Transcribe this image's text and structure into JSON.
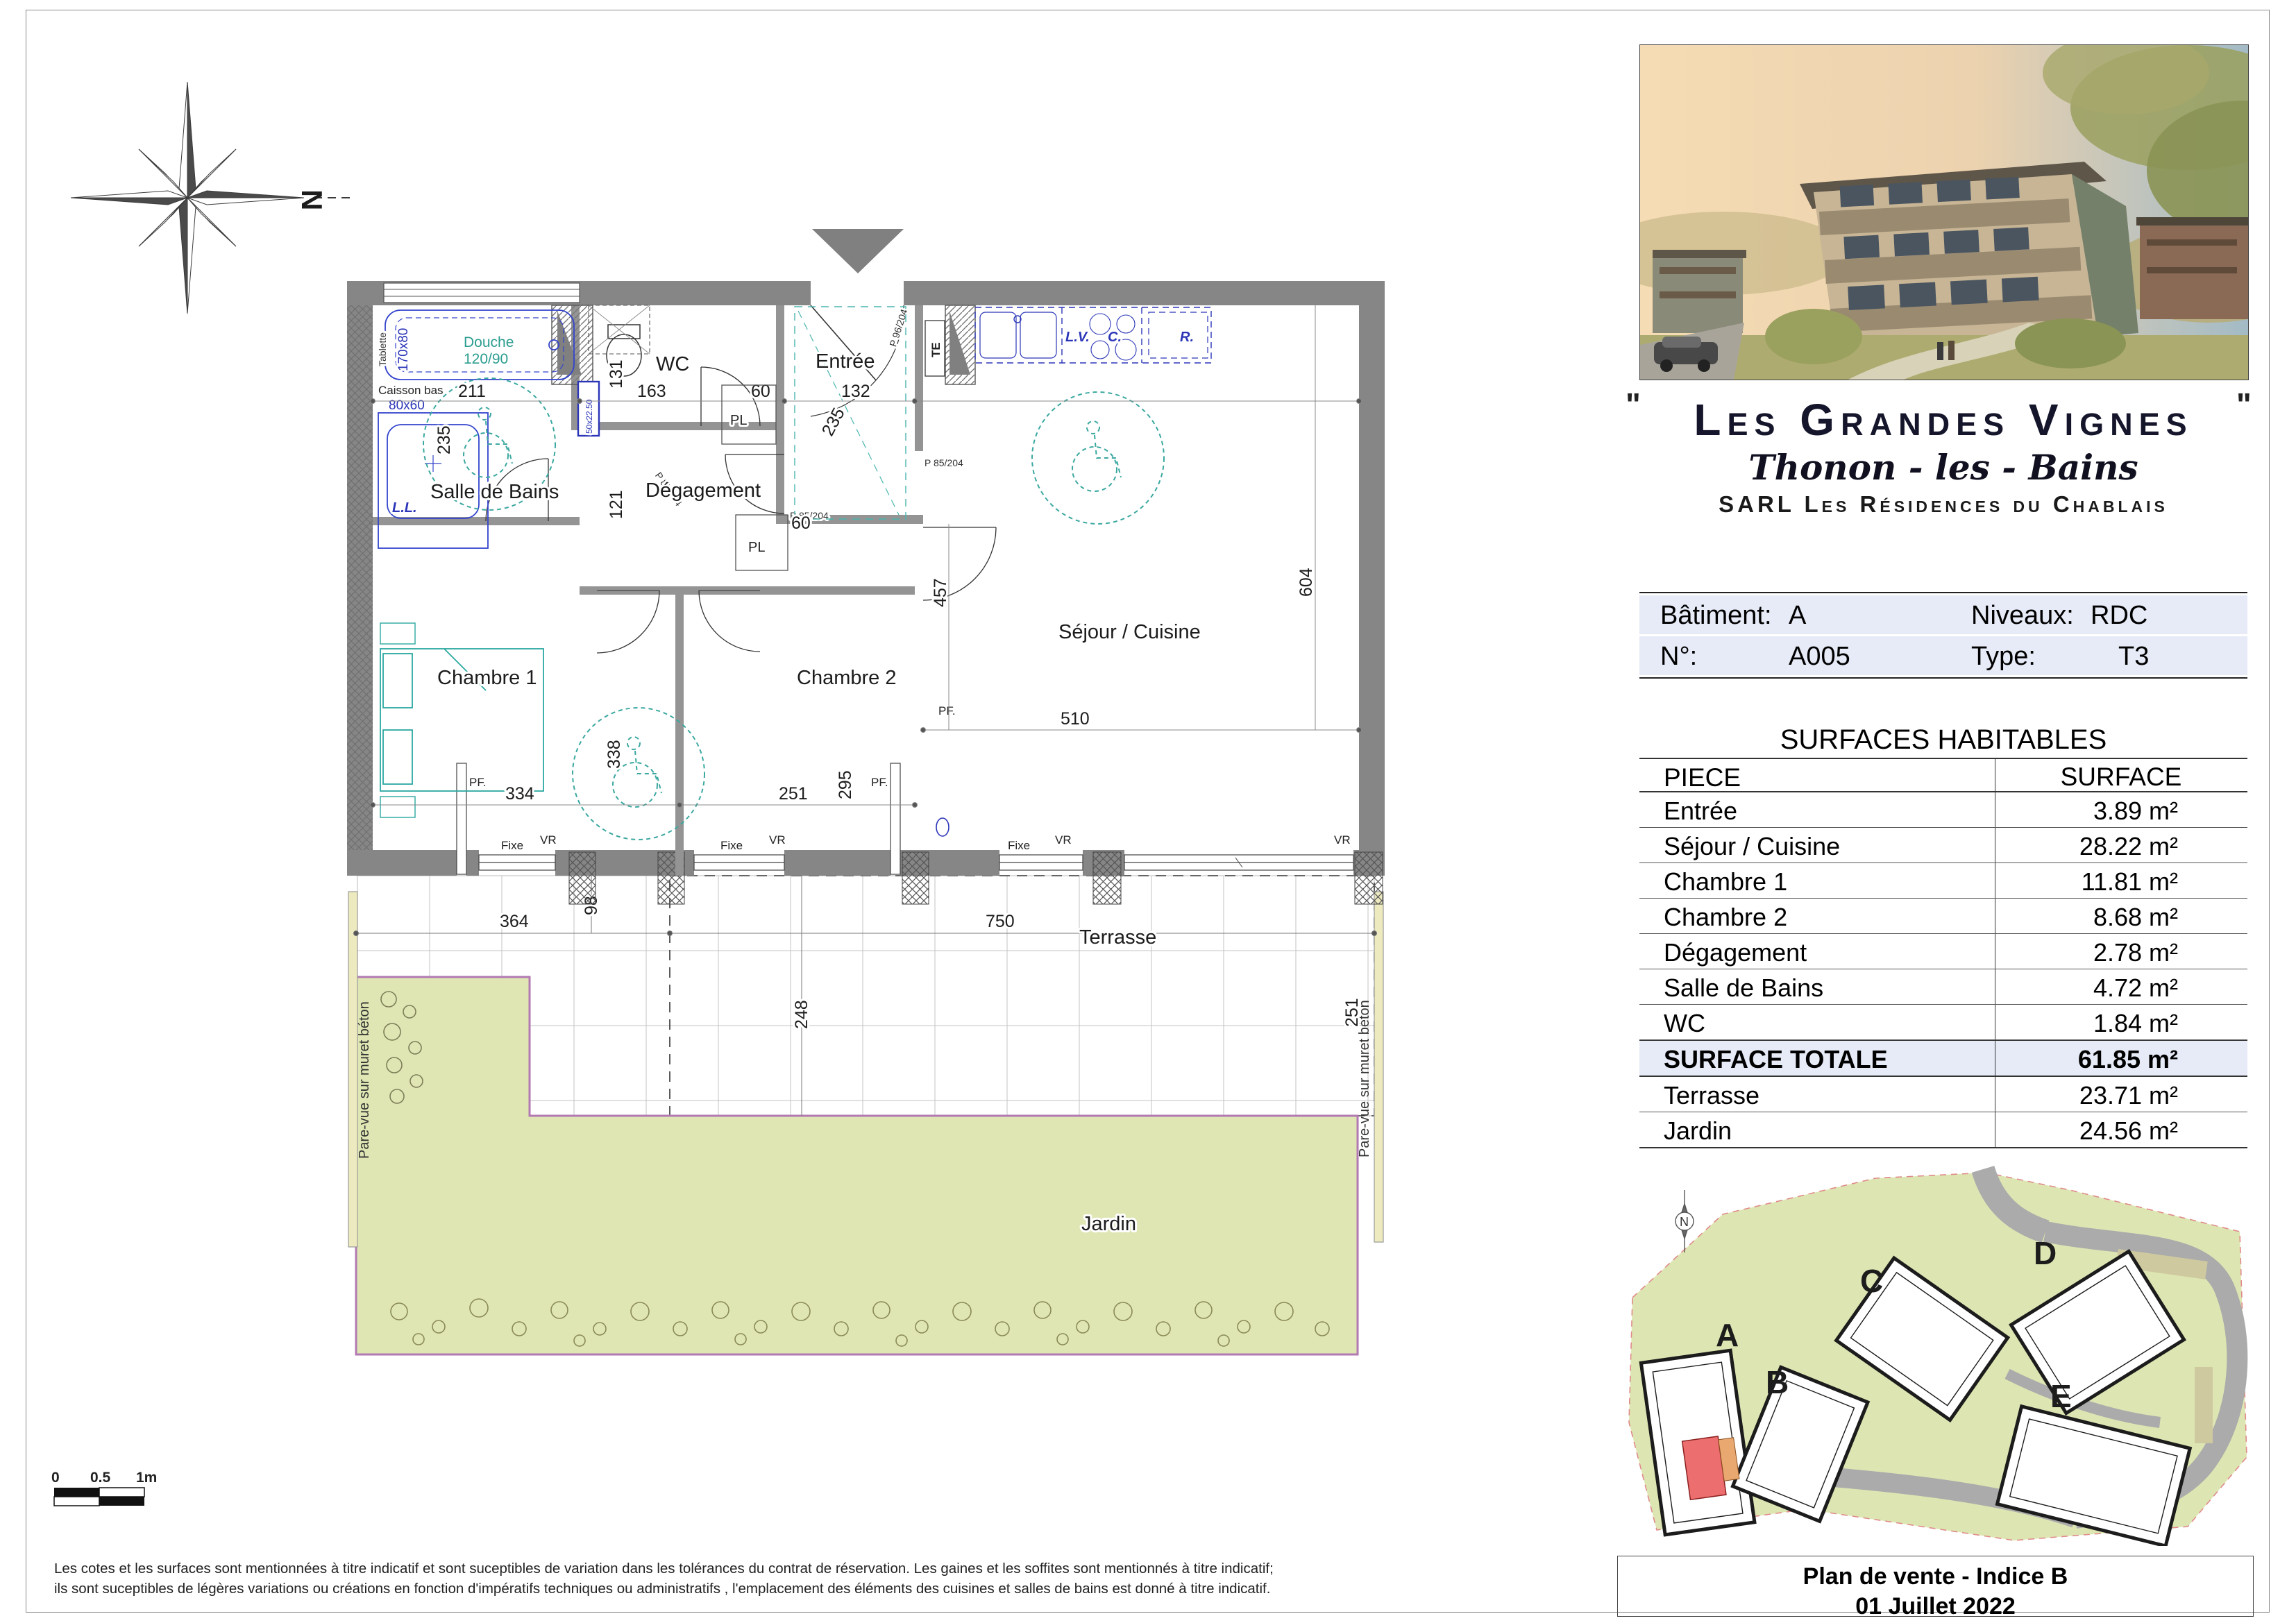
{
  "compass": {
    "north": "N"
  },
  "plan": {
    "rooms": {
      "salle_de_bains": "Salle de Bains",
      "degagement": "Dégagement",
      "wc": "WC",
      "entree": "Entrée",
      "chambre1": "Chambre 1",
      "chambre2": "Chambre 2",
      "sejour": "Séjour / Cuisine",
      "terrasse": "Terrasse",
      "jardin": "Jardin"
    },
    "dims": {
      "d211": "211",
      "d235": "235",
      "d131": "131",
      "d163": "163",
      "d60": "60",
      "d132": "132",
      "d121": "121",
      "d457": "457",
      "d604": "604",
      "d334": "334",
      "d338": "338",
      "d251": "251",
      "d295": "295",
      "d510": "510",
      "d364": "364",
      "d98": "98",
      "d750": "750",
      "d248": "248"
    },
    "fixtures": {
      "douche": "Douche",
      "douche_size": "120/90",
      "bain_size": "170x80",
      "tablette": "Tablette",
      "caisson": "Caisson bas",
      "vasque": "80x60",
      "ll": "L.L.",
      "lavabo": "50x22.50",
      "lv": "L.V.",
      "c": "C.",
      "r": "R.",
      "te": "TE"
    },
    "openings": {
      "pf": "PF.",
      "fixe": "Fixe",
      "vr": "VR",
      "p85": "P 85/204",
      "p96": "P 96/204"
    },
    "pare_vue": "Pare-vue sur muret béton"
  },
  "scale_bar": {
    "t0": "0",
    "t05": "0.5",
    "t1": "1m"
  },
  "disclaimer": {
    "line1": "Les cotes et les surfaces sont mentionnées à titre indicatif et sont suceptibles de variation dans les tolérances du contrat de réservation. Les gaines et les soffites sont mentionnés à titre indicatif;",
    "line2": "ils sont suceptibles de légères variations ou créations en fonction d'impératifs techniques ou administratifs , l'emplacement des éléments des cuisines et salles de bains est donné à titre indicatif."
  },
  "panel": {
    "quote": "\"",
    "title": "Les Grandes Vignes",
    "city": "Thonon - les - Bains",
    "company": "SARL Les Résidences du Chablais",
    "info": {
      "batiment_label": "Bâtiment:",
      "batiment_value": "A",
      "niveaux_label": "Niveaux:",
      "niveaux_value": "RDC",
      "numero_label": "N°:",
      "numero_value": "A005",
      "type_label": "Type:",
      "type_value": "T3"
    },
    "surfaces": {
      "title": "SURFACES HABITABLES",
      "col_piece": "PIECE",
      "col_surface": "SURFACE",
      "rows": [
        {
          "piece": "Entrée",
          "surface": "3.89 m²"
        },
        {
          "piece": "Séjour / Cuisine",
          "surface": "28.22 m²"
        },
        {
          "piece": "Chambre 1",
          "surface": "11.81 m²"
        },
        {
          "piece": "Chambre 2",
          "surface": "8.68 m²"
        },
        {
          "piece": "Dégagement",
          "surface": "2.78 m²"
        },
        {
          "piece": "Salle de Bains",
          "surface": "4.72 m²"
        },
        {
          "piece": "WC",
          "surface": "1.84 m²"
        }
      ],
      "total": {
        "piece": "SURFACE TOTALE",
        "surface": "61.85 m²"
      },
      "extra_rows": [
        {
          "piece": "Terrasse",
          "surface": "23.71 m²"
        },
        {
          "piece": "Jardin",
          "surface": "24.56 m²"
        }
      ]
    },
    "site": {
      "a": "A",
      "b": "B",
      "c": "C",
      "d": "D",
      "e": "E",
      "north": "N"
    },
    "footer": {
      "line1": "Plan de vente - Indice B",
      "line2": "01 Juillet 2022"
    }
  }
}
